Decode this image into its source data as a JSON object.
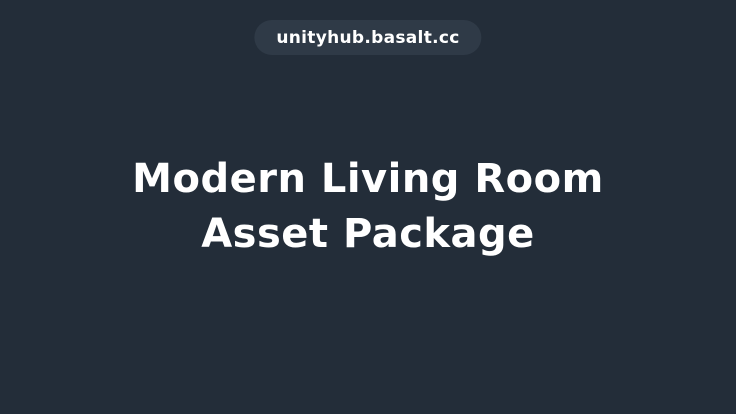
{
  "page": {
    "background_color": "#232D39",
    "badge": {
      "label": "unityhub.basalt.cc",
      "background_color": "#2F3A47",
      "text_color": "#FFFFFF"
    },
    "hero": {
      "title_line1": "Modern Living Room",
      "title_line2": "Asset Package",
      "text_color": "#FFFFFF"
    }
  }
}
